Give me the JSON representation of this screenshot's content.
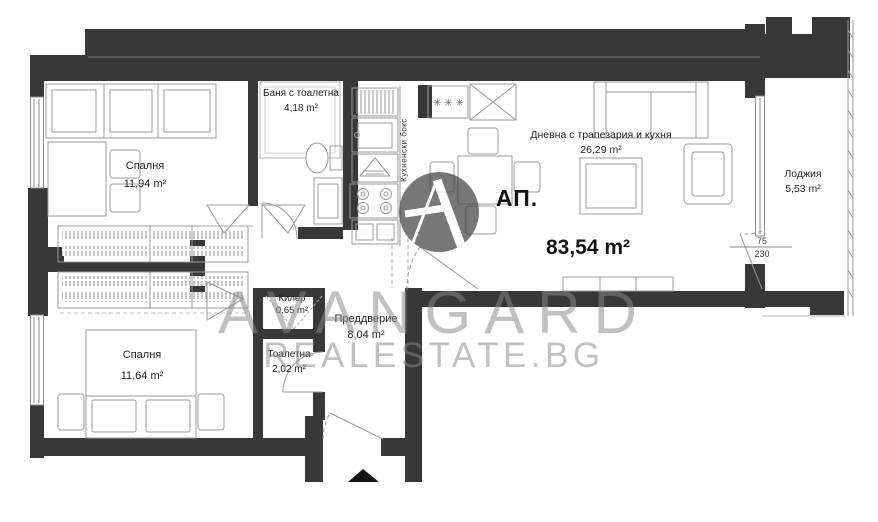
{
  "plan": {
    "apartment_label": "АП.",
    "total_area": "83,54 m²",
    "rooms": [
      {
        "name": "Спалня",
        "area": "11,94 m²"
      },
      {
        "name": "Баня с тоалетна",
        "area": "4,18 m²"
      },
      {
        "name": "Кухненски бокс",
        "area": ""
      },
      {
        "name": "Дневна с трапезария и кухня",
        "area": "26,29 m²"
      },
      {
        "name": "Лоджия",
        "area": "5,53 m²"
      },
      {
        "name": "Спалня",
        "area": "11,64 m²"
      },
      {
        "name": "Килер",
        "area": "0,65 m²"
      },
      {
        "name": "Тоалетна",
        "area": "2,02 m²"
      },
      {
        "name": "Преддверие",
        "area": "8,04 m²"
      }
    ],
    "door_dimension": {
      "width": "75",
      "height": "230"
    },
    "stove_symbols": "✳ ✳ ✳"
  },
  "watermark": {
    "line1": "AVANGARD",
    "line2": "REALESTATE.BG",
    "logo": "avangard-a-logo"
  },
  "colors": {
    "wall": "#383838",
    "furniture_line": "#9a9a9a",
    "text": "#1e1e1e",
    "watermark": "#878787"
  }
}
